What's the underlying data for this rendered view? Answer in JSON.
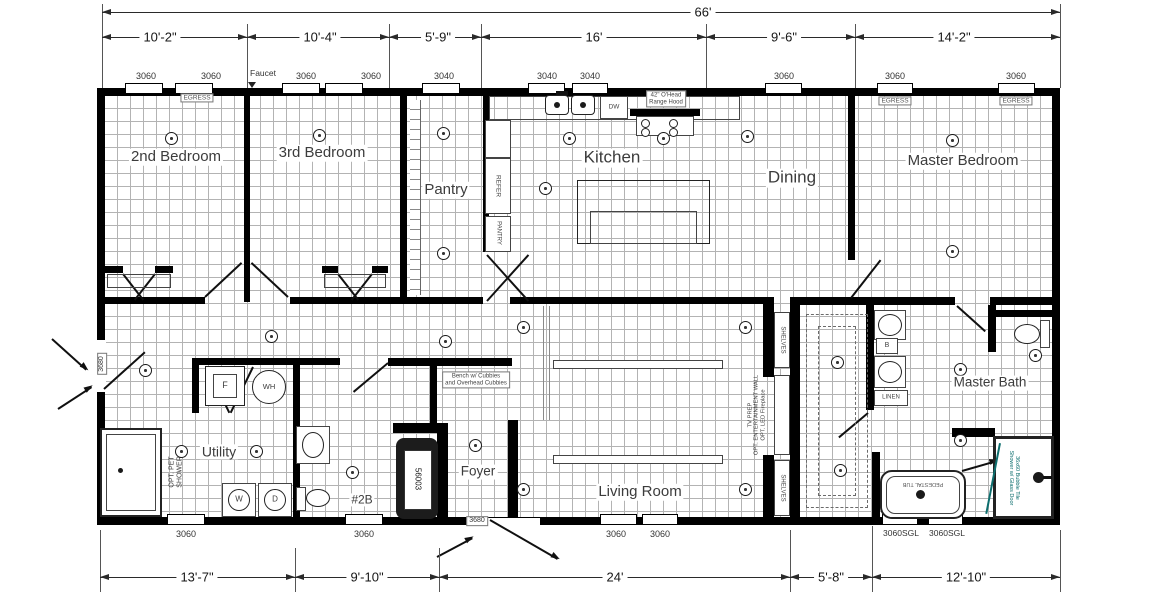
{
  "dimensions": {
    "overall": "66'",
    "top": [
      "10'-2\"",
      "10'-4\"",
      "5'-9\"",
      "16'",
      "9'-6\"",
      "14'-2\""
    ],
    "bottom": [
      "13'-7\"",
      "9'-10\"",
      "24'",
      "5'-8\"",
      "12'-10\""
    ]
  },
  "windows": {
    "top": [
      "3060",
      "3060",
      "3060",
      "3060",
      "3040",
      "3040",
      "3040",
      "3060",
      "3060",
      "3060"
    ],
    "bottom": [
      "3060",
      "3060",
      "3060",
      "3060",
      "3060SGL",
      "3060SGL"
    ],
    "egress": "EGRESS"
  },
  "doors": {
    "side": "3680",
    "front": "3680"
  },
  "rooms": {
    "bedroom2": "2nd Bedroom",
    "bedroom3": "3rd Bedroom",
    "pantry": "Pantry",
    "kitchen": "Kitchen",
    "dining": "Dining",
    "master_bedroom": "Master Bedroom",
    "utility": "Utility",
    "bath2": "#2B",
    "foyer": "Foyer",
    "living": "Living Room",
    "master_bath": "Master Bath"
  },
  "fixtures": {
    "faucet": "Faucet",
    "refrigerator": "REFER",
    "pantry_cabinet": "PANTRY",
    "dishwasher": "DW",
    "range_hood_line1": "42\" O'Head",
    "range_hood_line2": "Range Hood",
    "washer": "W",
    "dryer": "D",
    "furnace": "F",
    "water_heater": "WH",
    "pet_shower_line1": "OPT. PET",
    "pet_shower_line2": "SHOWER",
    "tub_model": "56003",
    "bench_line1": "Bench w/ Cubbies",
    "bench_line2": "and Overhead Cubbies",
    "shelves": "SHELVES",
    "linen": "LINEN",
    "base_cabinet": "B",
    "pedestal_tub": "PEDESTAL TUB",
    "shower_note_line1": "36x60 Bubble Tile",
    "shower_note_line2": "Shower w/ Glass Door",
    "ent_wall_line1": "TV PREP",
    "ent_wall_line2": "OPT. ENTERTAINMENT WALL",
    "ent_wall_line3": "OPT. LED Fireplace"
  },
  "colors": {
    "accent_teal": "#0d6e6e",
    "wall": "#000000",
    "grid": "#b3b3b3"
  }
}
